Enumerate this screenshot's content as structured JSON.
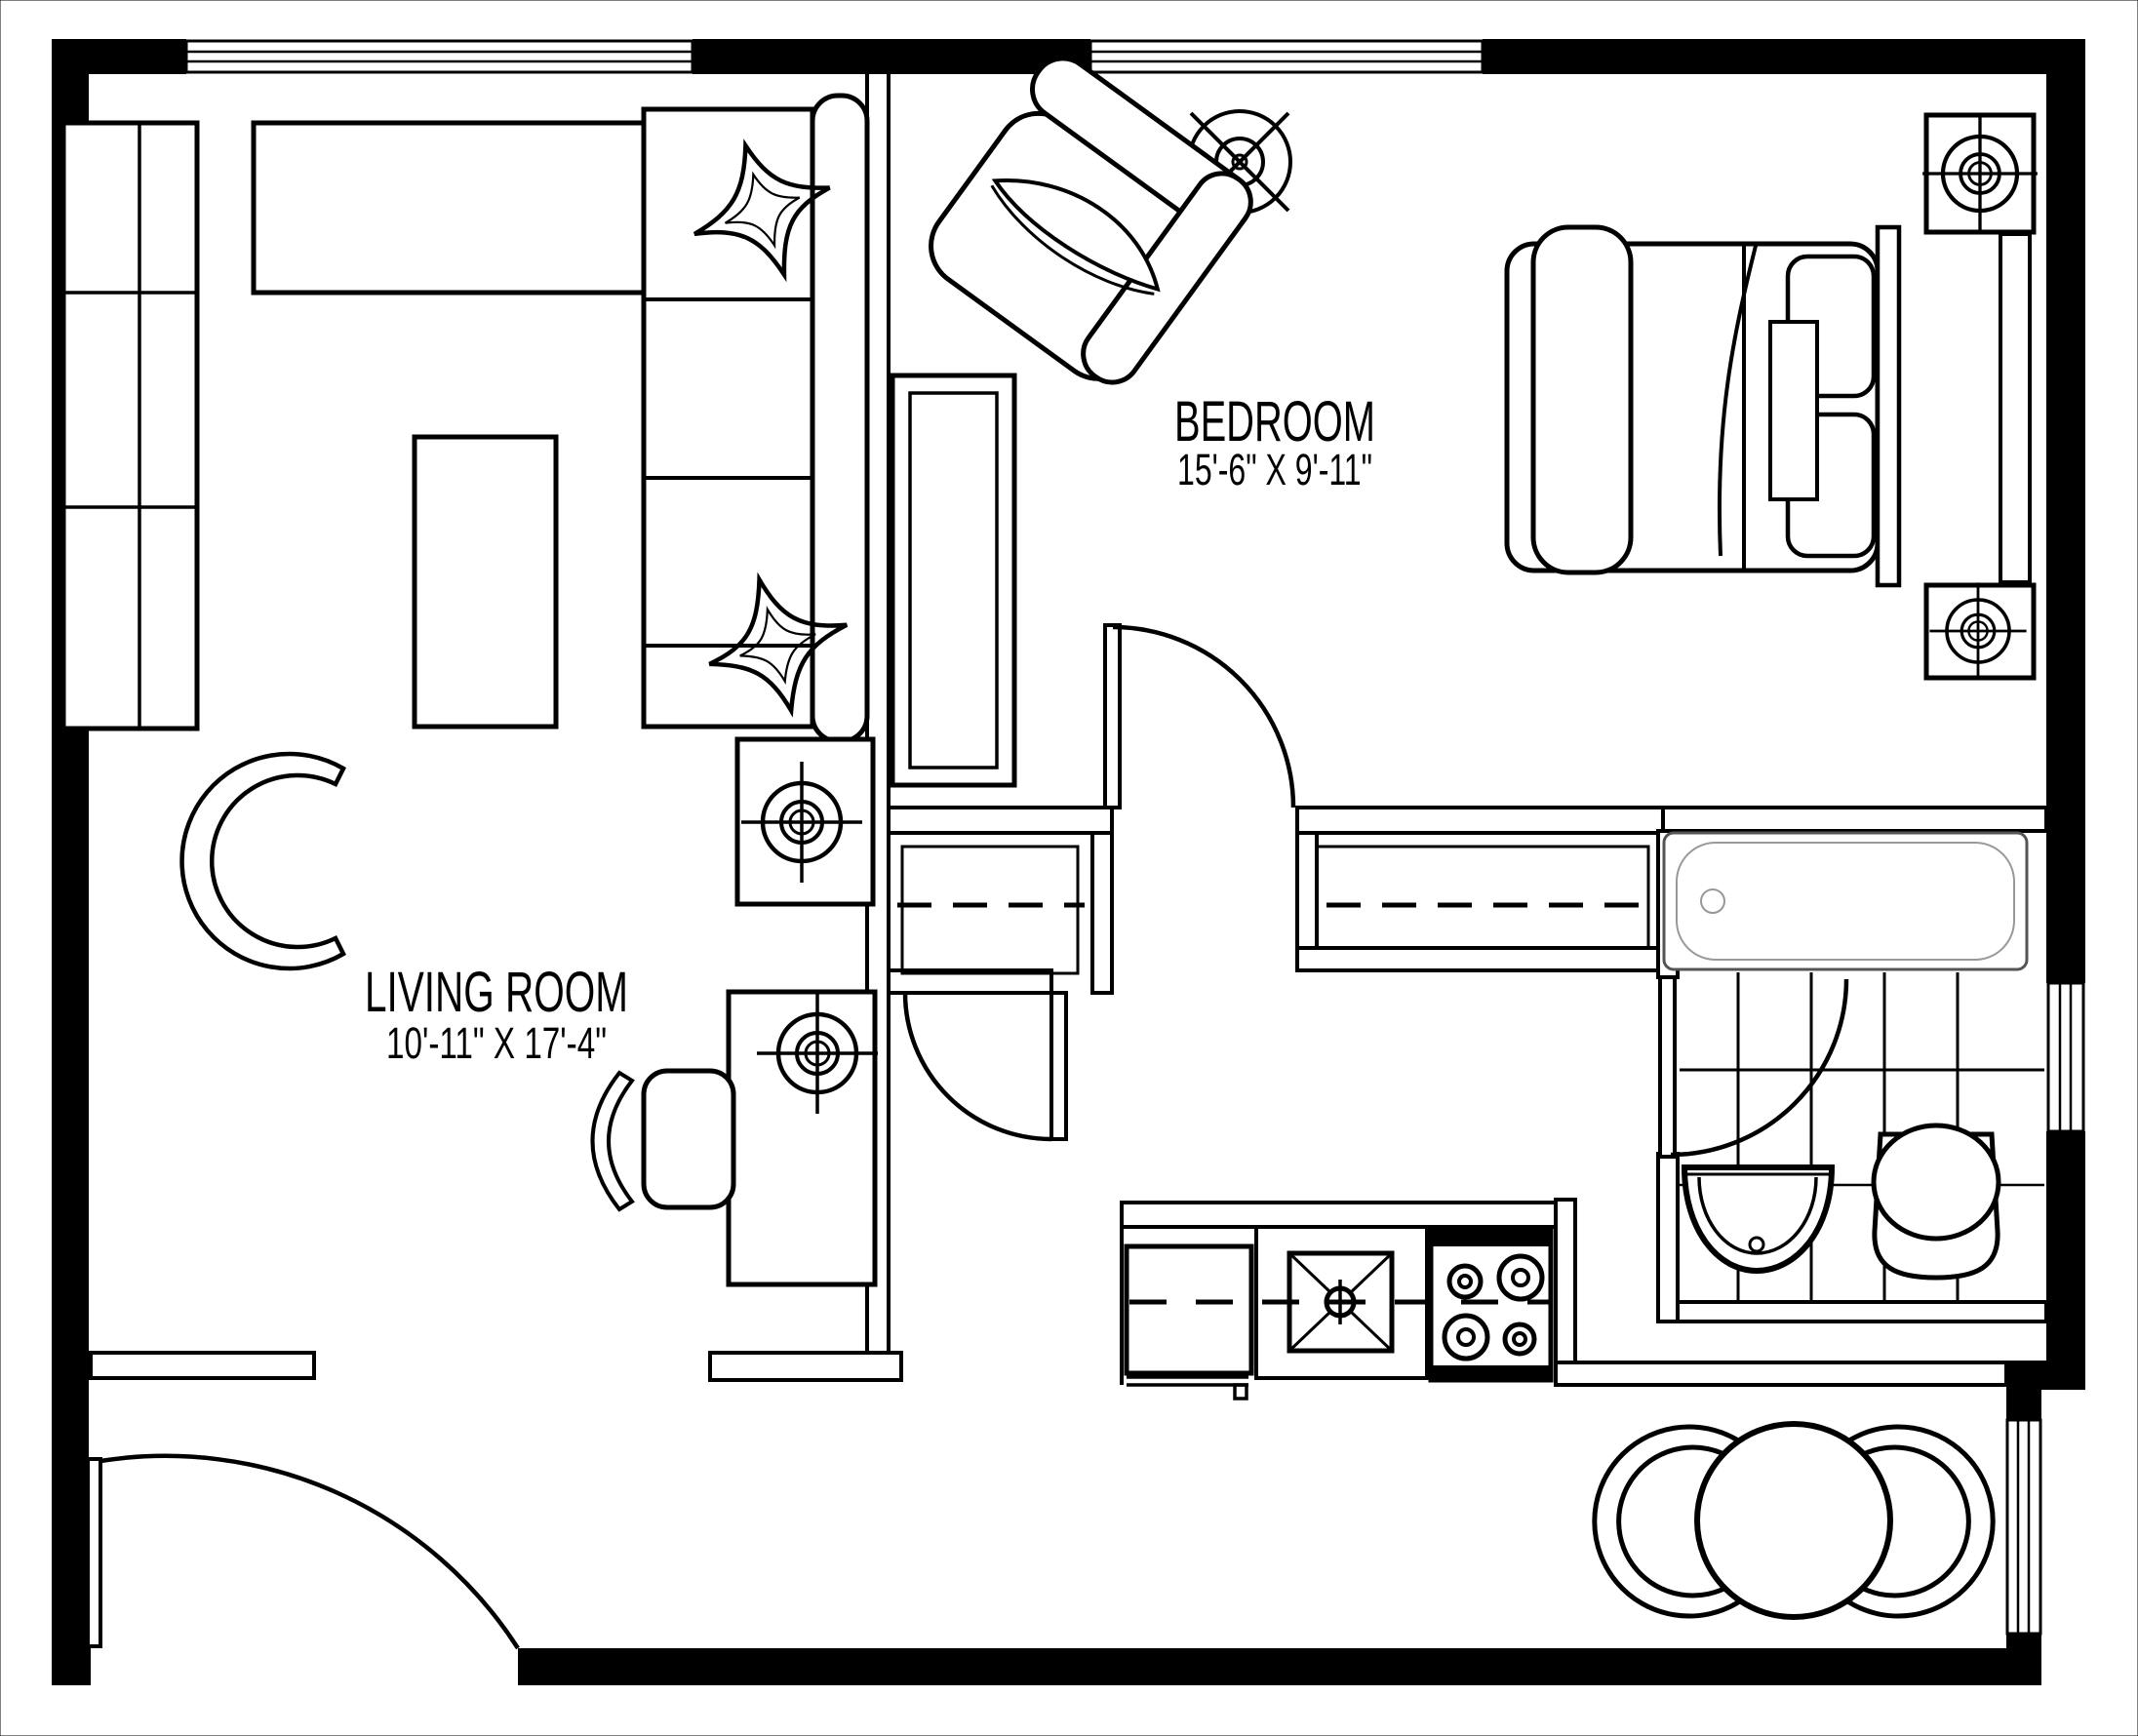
{
  "plan": {
    "type": "apartment-floor-plan",
    "rooms": {
      "bedroom": {
        "label": "BEDROOM",
        "dimensions": "15'-6\" X 9'-11\""
      },
      "living_room": {
        "label": "LIVING ROOM",
        "dimensions": "10'-11\" X 17'-4\""
      }
    },
    "colors": {
      "line": "#000000",
      "background": "#ffffff",
      "tub_outline": "#999999"
    }
  }
}
